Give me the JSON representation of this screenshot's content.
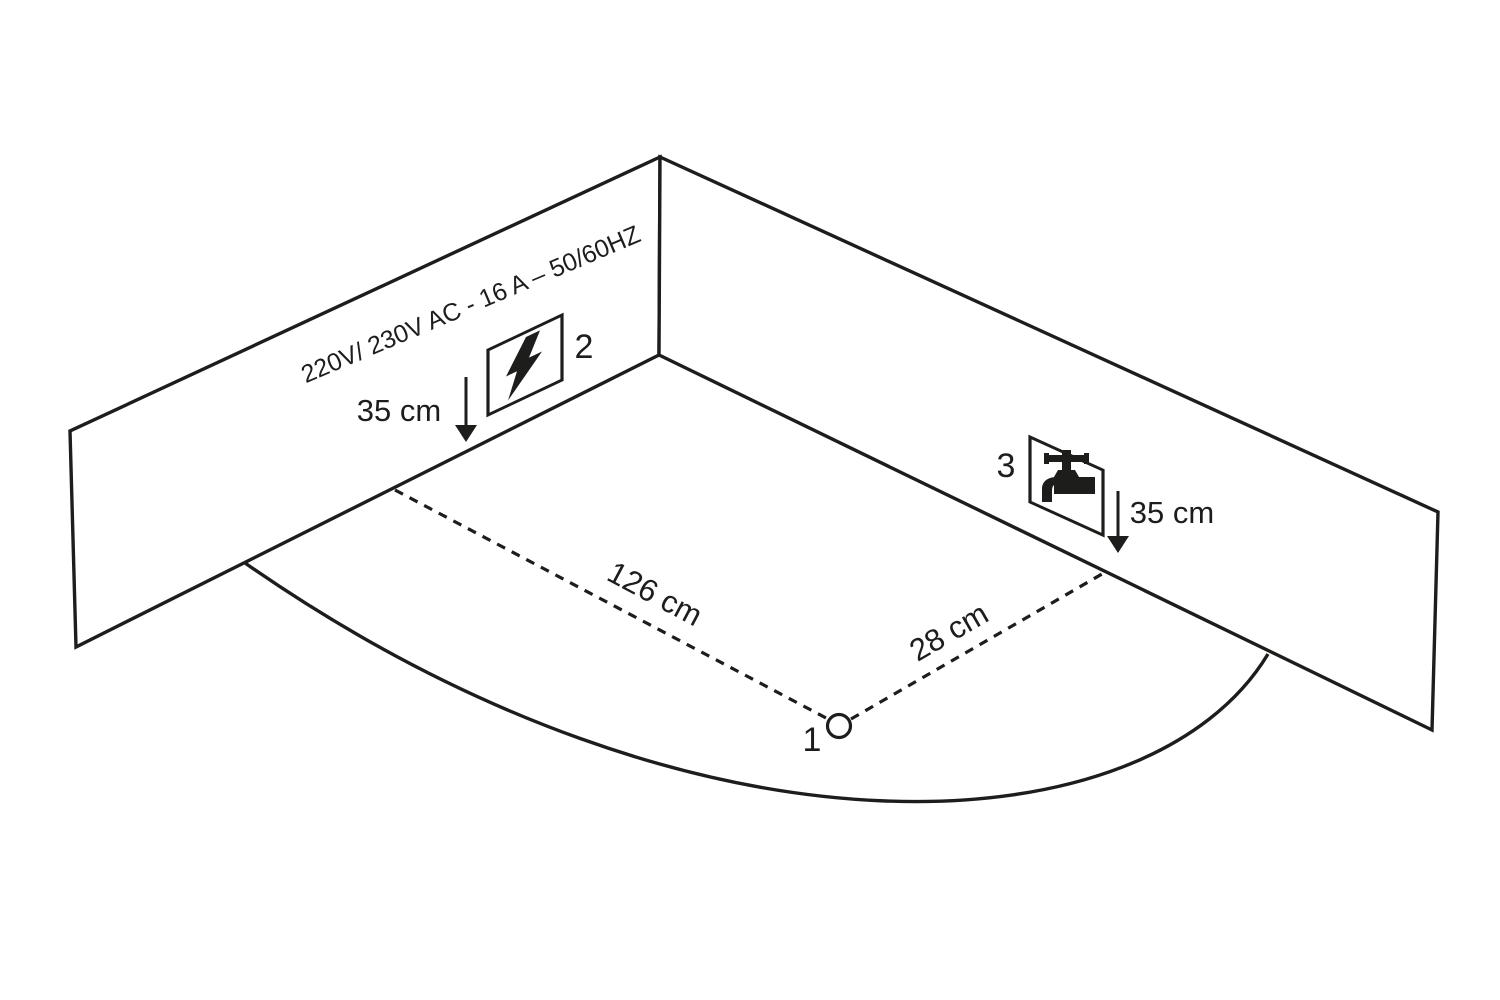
{
  "diagram": {
    "title": "corner-installation-diagram",
    "wall_spec": "220V/ 230V AC - 16 A – 50/60HZ",
    "labels": {
      "point_1": "1",
      "point_2": "2",
      "point_3": "3"
    },
    "measurements": {
      "outlet_height": "35 cm",
      "tap_height": "35 cm",
      "distance_left_wall": "126 cm",
      "distance_right_wall": "28 cm"
    },
    "icons": {
      "electric": "lightning-icon",
      "water": "tap-icon"
    },
    "colors": {
      "line": "#1d1d1b",
      "background": "#ffffff"
    }
  }
}
